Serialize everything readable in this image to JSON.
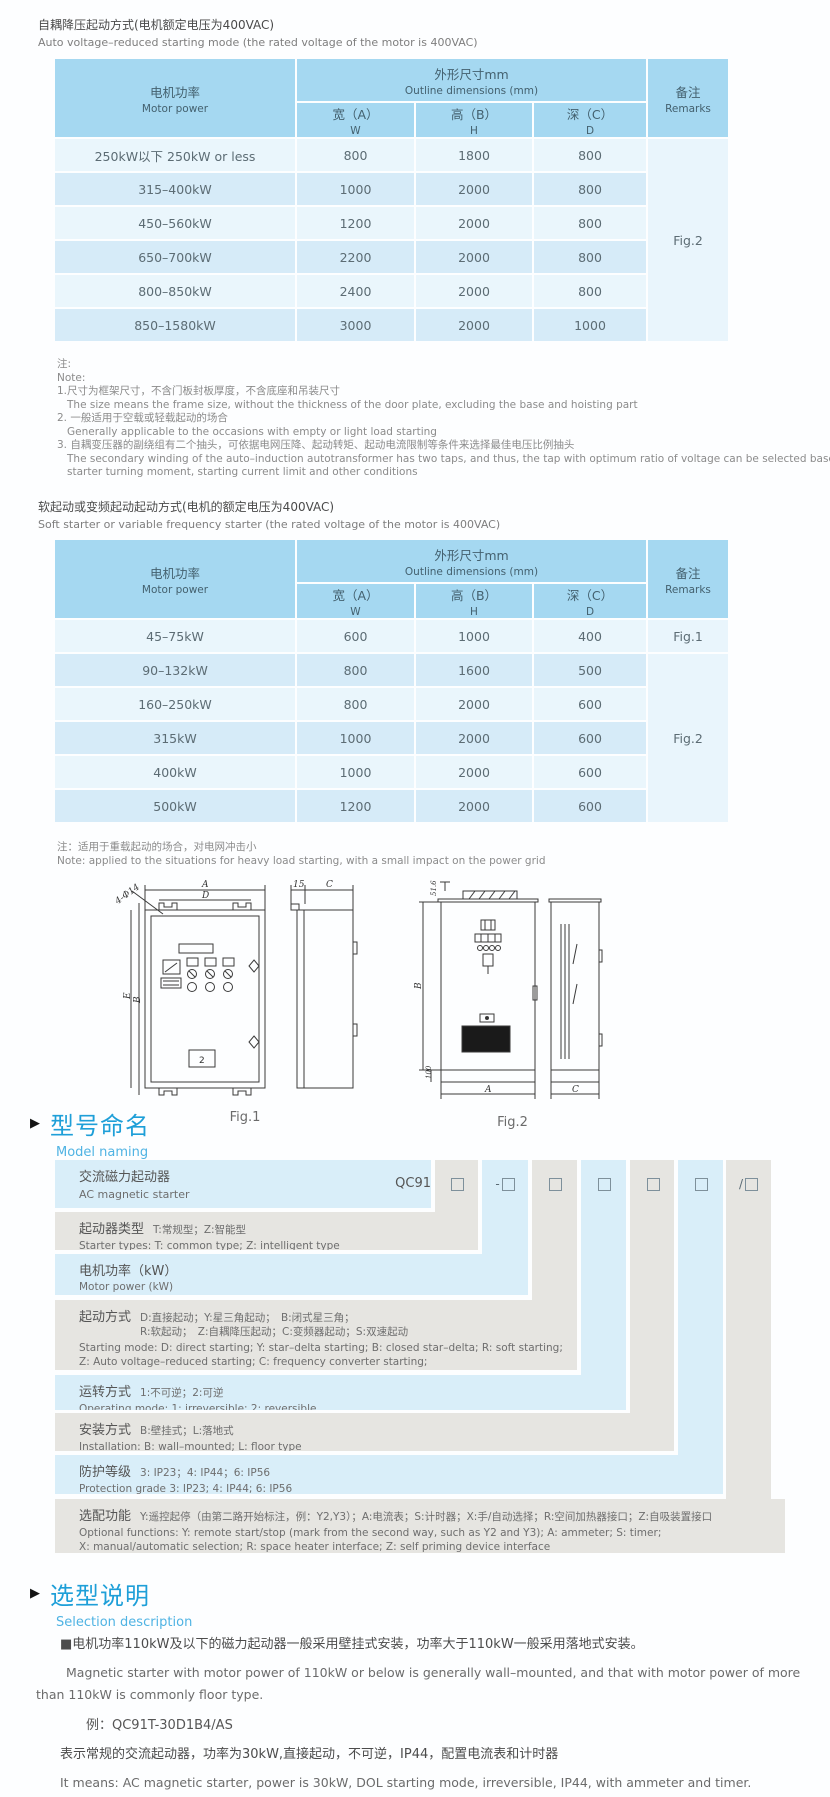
{
  "colors": {
    "accent_blue": "#1E9FD8",
    "table_header": "#A5D8F1",
    "row_light": "#EAF6FC",
    "row_dark": "#D6EBF8",
    "naming_blue": "#D9EEF9",
    "naming_gray": "#E6E5E1"
  },
  "th": {
    "motor_zh": "电机功率",
    "motor_en": "Motor power",
    "outline_zh": "外形尺寸mm",
    "outline_en": "Outline dimensions (mm)",
    "w_zh": "宽（A）",
    "w_en": "W",
    "h_zh": "高（B）",
    "h_en": "H",
    "d_zh": "深（C）",
    "d_en": "D",
    "remarks_zh": "备注",
    "remarks_en": "Remarks"
  },
  "t1": {
    "title_zh": "自耦降压起动方式(电机额定电压为400VAC)",
    "title_en": "Auto voltage–reduced starting mode (the rated voltage of the motor is 400VAC)",
    "rows": [
      {
        "power": "250kW以下 250kW or less",
        "w": "800",
        "h": "1800",
        "d": "800"
      },
      {
        "power": "315–400kW",
        "w": "1000",
        "h": "2000",
        "d": "800"
      },
      {
        "power": "450–560kW",
        "w": "1200",
        "h": "2000",
        "d": "800"
      },
      {
        "power": "650–700kW",
        "w": "2200",
        "h": "2000",
        "d": "800"
      },
      {
        "power": "800–850kW",
        "w": "2400",
        "h": "2000",
        "d": "800"
      },
      {
        "power": "850–1580kW",
        "w": "3000",
        "h": "2000",
        "d": "1000"
      }
    ],
    "remark": "Fig.2",
    "notes": [
      "注:",
      "Note:",
      "1.尺寸为框架尺寸，不含门板封板厚度，不含底座和吊装尺寸",
      "The size means the frame size, without the thickness of the door plate, excluding the base and hoisting part",
      "2. 一般适用于空载或轻载起动的场合",
      "Generally applicable to the occasions with empty or light load starting",
      "3. 自耦变压器的副绕组有二个抽头，可依据电网压降、起动转矩、起动电流限制等条件来选择最佳电压比例抽头",
      "The secondary winding of the auto–induction autotransformer has two taps, and thus, the tap with optimum ratio of voltage can be selected based on power network voltage drop,",
      "starter turning moment, starting current limit and other conditions"
    ]
  },
  "t2": {
    "title_zh": "软起动或变频起动起动方式(电机的额定电压为400VAC)",
    "title_en": "Soft starter or variable frequency starter (the rated voltage of the motor is 400VAC)",
    "rows": [
      {
        "power": "45–75kW",
        "w": "600",
        "h": "1000",
        "d": "400",
        "remark": "Fig.1"
      },
      {
        "power": "90–132kW",
        "w": "800",
        "h": "1600",
        "d": "500"
      },
      {
        "power": "160–250kW",
        "w": "800",
        "h": "2000",
        "d": "600"
      },
      {
        "power": "315kW",
        "w": "1000",
        "h": "2000",
        "d": "600"
      },
      {
        "power": "400kW",
        "w": "1000",
        "h": "2000",
        "d": "600"
      },
      {
        "power": "500kW",
        "w": "1200",
        "h": "2000",
        "d": "600"
      }
    ],
    "remark2": "Fig.2",
    "note_zh": "注：适用于重载起动的场合，对电网冲击小",
    "note_en": "Note: applied to the situations for heavy load starting, with a small impact on the power grid"
  },
  "figs": {
    "fig1_label": "Fig.1",
    "fig2_label": "Fig.2",
    "f1": {
      "a": "A",
      "d": "D",
      "hole": "4-Φ14",
      "e": "E",
      "b": "B",
      "s15": "15",
      "c": "C",
      "panel": "2"
    },
    "f2": {
      "v516": "51.6",
      "b": "B",
      "v100": "100",
      "a": "A",
      "c": "C"
    }
  },
  "naming": {
    "title_zh": "型号命名",
    "title_en": "Model naming",
    "code": "QC91",
    "boxes": [
      {
        "prefix": ""
      },
      {
        "prefix": "-"
      },
      {
        "prefix": ""
      },
      {
        "prefix": ""
      },
      {
        "prefix": ""
      },
      {
        "prefix": ""
      },
      {
        "prefix": "/"
      }
    ],
    "rows": [
      {
        "zh": "交流磁力起动器",
        "en": "AC magnetic starter"
      },
      {
        "label": "起动器类型",
        "desc": "T:常规型；Z:智能型",
        "en": "Starter types: T: common type; Z: intelligent type"
      },
      {
        "label": "电机功率（kW）",
        "desc": "",
        "en": "Motor power (kW)"
      },
      {
        "label": "起动方式",
        "desc": "D:直接起动；Y:星三角起动；　B:闭式星三角；\nR:软起动；　Z:自耦降压起动；C:变频器起动；S:双速起动",
        "en": "Starting mode: D: direct starting; Y: star–delta starting; B: closed star–delta; R: soft starting;\nZ: Auto voltage–reduced starting; C: frequency converter starting;\nS: double speed starting"
      },
      {
        "label": "运转方式",
        "desc": "1:不可逆；2:可逆",
        "en": "Operating mode: 1: irreversible; 2: reversible"
      },
      {
        "label": "安装方式",
        "desc": "B:壁挂式；L:落地式",
        "en": "Installation: B: wall–mounted; L: floor type"
      },
      {
        "label": "防护等级",
        "desc": "3: IP23；4: IP44；6: IP56",
        "en": "Protection grade  3: IP23; 4: IP44; 6: IP56"
      },
      {
        "label": "选配功能",
        "desc": "Y:遥控起停（由第二路开始标注，例：Y2,Y3）；A:电流表；S:计时器；X:手/自动选择；R:空间加热器接口；Z:自吸装置接口",
        "en": "Optional functions: Y: remote start/stop (mark from the second way, such as Y2 and Y3); A: ammeter; S: timer;\nX: manual/automatic selection; R: space heater interface; Z: self priming device interface"
      }
    ]
  },
  "sel": {
    "title_zh": "选型说明",
    "title_en": "Selection description",
    "p1_zh": "■电机功率110kW及以下的磁力起动器一般采用壁挂式安装，功率大于110kW一般采用落地式安装。",
    "p1_en": "Magnetic starter with motor power of 110kW or below is generally wall–mounted, and that with motor power of more than 110kW is commonly floor type.",
    "example": "例：QC91T-30D1B4/AS",
    "ex_zh": "表示常规的交流起动器，功率为30kW,直接起动，不可逆，IP44，配置电流表和计时器",
    "ex_en": "It means: AC magnetic starter, power is 30kW, DOL starting mode, irreversible, IP44, with ammeter and timer."
  }
}
